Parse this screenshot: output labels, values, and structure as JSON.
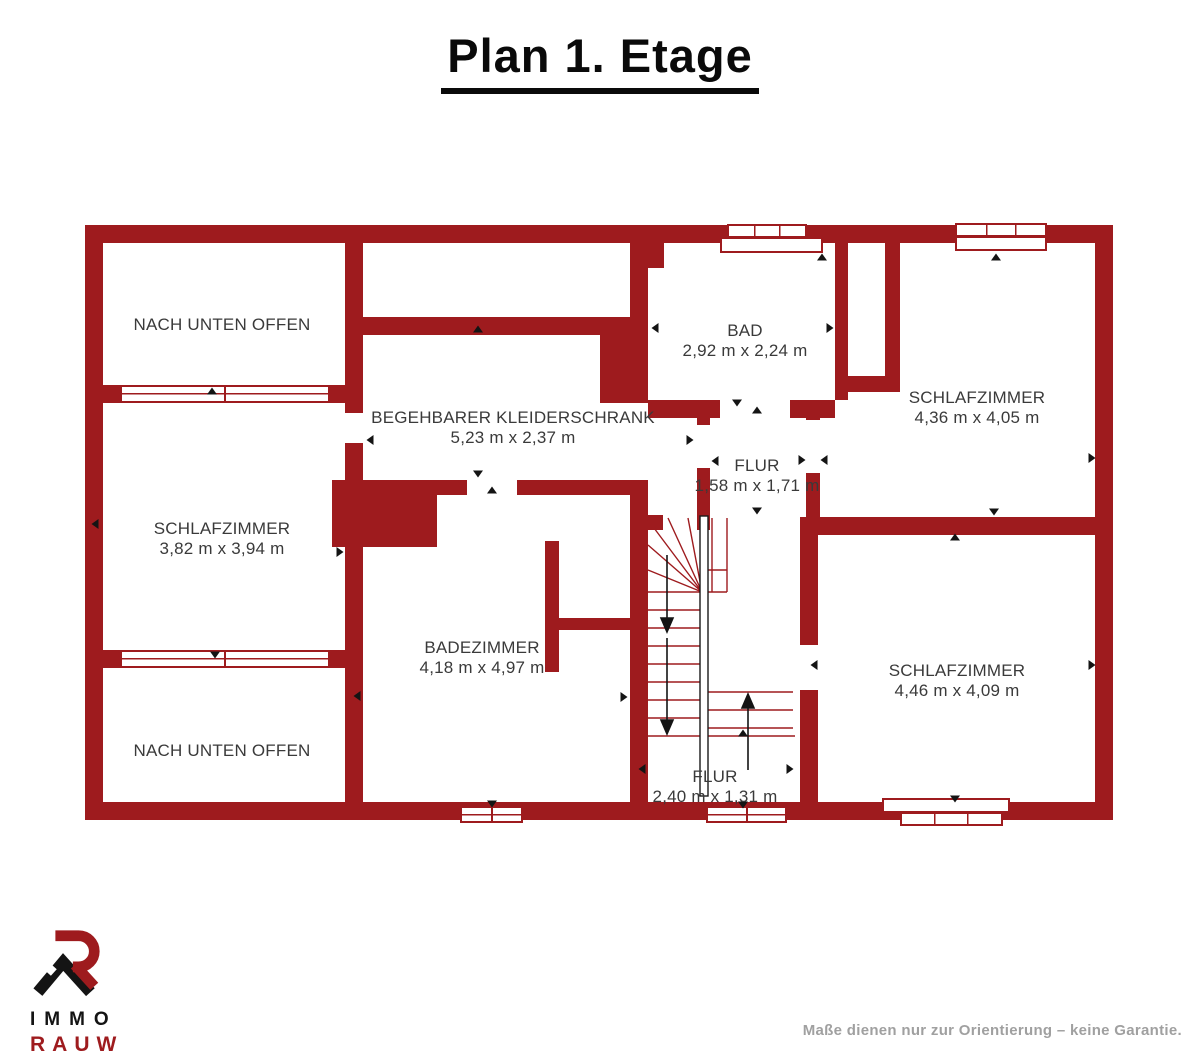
{
  "title": "Plan 1. Etage",
  "colors": {
    "wall": "#9e1b1e",
    "label": "#3a3a3a",
    "arrow": "#141414",
    "muted": "#a0a0a0"
  },
  "rooms": [
    {
      "id": "nach-unten-offen-top",
      "name": "NACH UNTEN OFFEN",
      "dims": ""
    },
    {
      "id": "schlafzimmer-links",
      "name": "SCHLAFZIMMER",
      "dims": "3,82 m x 3,94 m"
    },
    {
      "id": "nach-unten-offen-unten",
      "name": "NACH UNTEN OFFEN",
      "dims": ""
    },
    {
      "id": "begehbarer-kleiderschrank",
      "name": "BEGEHBARER KLEIDERSCHRANK",
      "dims": "5,23 m x 2,37 m"
    },
    {
      "id": "bad",
      "name": "BAD",
      "dims": "2,92 m x 2,24 m"
    },
    {
      "id": "schlafzimmer-oben-rechts",
      "name": "SCHLAFZIMMER",
      "dims": "4,36 m x 4,05 m"
    },
    {
      "id": "flur-mitte",
      "name": "FLUR",
      "dims": "1,58 m x 1,71 m"
    },
    {
      "id": "badezimmer",
      "name": "BADEZIMMER",
      "dims": "4,18 m x 4,97 m"
    },
    {
      "id": "schlafzimmer-unten-rechts",
      "name": "SCHLAFZIMMER",
      "dims": "4,46 m x 4,09 m"
    },
    {
      "id": "flur-unten",
      "name": "FLUR",
      "dims": "2,40 m x 1,31 m"
    }
  ],
  "footer": {
    "brand_line1": "IMMO",
    "brand_line2": "RAUW",
    "disclaimer": "Maße dienen nur zur Orientierung – keine Garantie."
  }
}
